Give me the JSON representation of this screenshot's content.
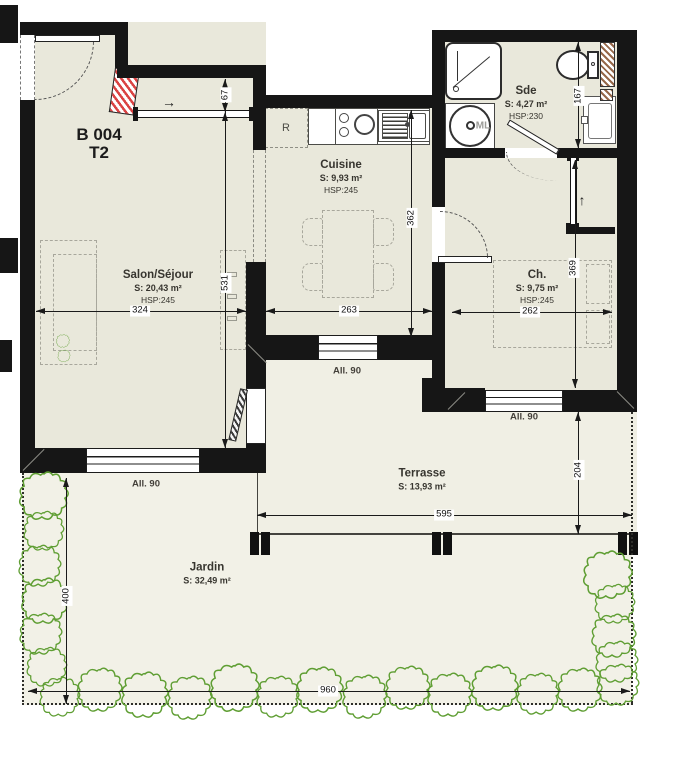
{
  "unit": {
    "code": "B 004",
    "type": "T2"
  },
  "rooms": {
    "salon": {
      "name": "Salon/Séjour",
      "area": "S: 20,43 m²",
      "hsp": "HSP:245"
    },
    "cuisine": {
      "name": "Cuisine",
      "area": "S: 9,93 m²",
      "hsp": "HSP:245"
    },
    "sde": {
      "name": "Sde",
      "area": "S: 4,27 m²",
      "hsp": "HSP:230"
    },
    "ch": {
      "name": "Ch.",
      "area": "S: 9,75 m²",
      "hsp": "HSP:245"
    },
    "terrasse": {
      "name": "Terrasse",
      "area": "S: 13,93 m²"
    },
    "jardin": {
      "name": "Jardin",
      "area": "S: 32,49 m²"
    }
  },
  "windows": {
    "salon": "All. 90",
    "cuisine": "All. 90",
    "ch": "All. 90"
  },
  "appliances": {
    "fridge": "R",
    "washer": "ML"
  },
  "dims": {
    "d67": "67",
    "d531": "531",
    "d324": "324",
    "d362": "362",
    "d263": "263",
    "d167": "167",
    "d369": "369",
    "d262": "262",
    "d204": "204",
    "d595": "595",
    "d400": "400",
    "d960": "960"
  },
  "arrows": {
    "entry": "→",
    "closet": "↑"
  },
  "colors": {
    "interior_floor": "#e9e8db",
    "exterior_floor": "#f1f0e6",
    "wall": "#161616",
    "plant_green": "#5f9e33",
    "duct_red": "#da4343",
    "duct_brown": "#96684a"
  }
}
